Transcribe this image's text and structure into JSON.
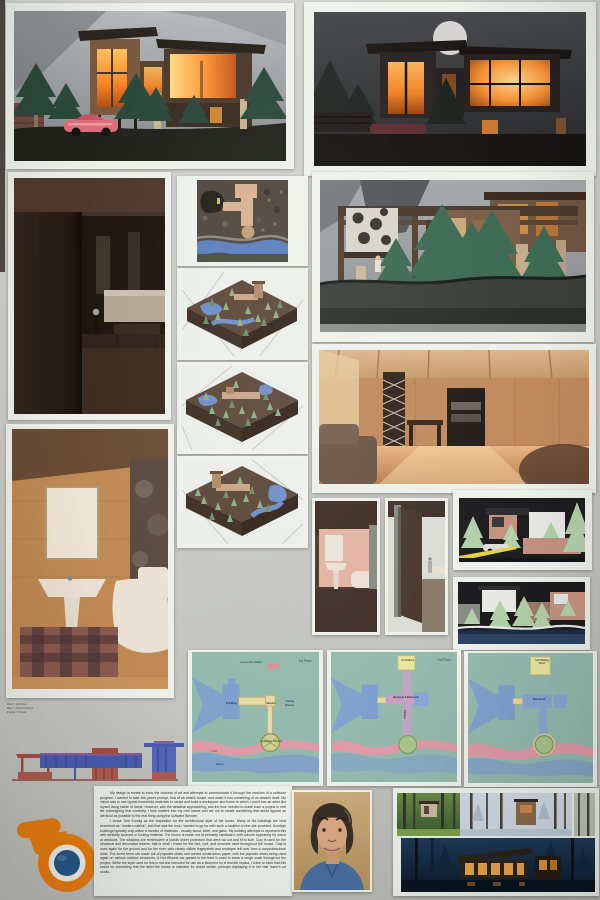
{
  "plans": [
    {
      "title": "1st Floor",
      "callout": "Guest Bed/Bath →",
      "parking": "Parking",
      "studio": "Studio",
      "living": "Living Room",
      "garden": "Sculpture Garden",
      "trail": "Trail",
      "river": "River"
    },
    {
      "title": "2nd Floor",
      "callout": "Art Gallery",
      "rooms": "Bedroom & Bathroom",
      "library": "Library"
    },
    {
      "callout": "Tall Sliding Roof",
      "roof": "Main Roof"
    }
  ],
  "legend": {
    "line1": "Red = 1st Floor",
    "line2": "Blue = Second Floor",
    "line3": "Purple = Roofs"
  },
  "statement": {
    "paragraph1": "My design is meant to echo the concept of art and attempts to communicate it through the medium of a software program. I wanted to take this year's prompt, that of an artist's house, and make it into something of an artwork itself. My vision was to use typical household materials to sculpt and build a workspace and home in which I could see an artist like myself living inside of home. However, with the deadline approaching, and the time needed to make such a project in real life outweighing that creativity, I took matters into my own hands and set out to create something that would appear as identical as possible to the real thing using the software Blender.",
    "paragraph2": "I chose Tom Kundig as the inspiration for the architectural style of the house. Many of his buildings are best described as \"modern cabins\", and that was the look I wanted to go for with such a location on the site provided. Kundig's buildings typically only utilize a handful of materials - usually wood, steel, and glass. My building attempts to represent this with similarly sourced or looking material. The house is made out of primarily cardboard, with cutouts appearing for doors or windows. The windows are reminiscent of plastic sheet protectors that were cut out and fit to size. Clay is used for the structural and decorative beams; that is what I chose for the bed, roof, and concrete used throughout the house. Clay is used again for the ground and for the river, with clearly visible fingerprints and smudges left over from a nonprofessional artist. The forest trees are made out of popsicle sticks and curved construction paper, with the popsicle sticks being used again on various outdoor structures. A Hot Wheels car parked in the front is used to show a rough scale throughout the project. While the style used for this is not one intended for use as a blueprint for a real-life replica, I'd like to think that this would be something that the artist the house is intended for would create, perhaps displaying it in her real home's art studio."
  },
  "colors": {
    "blender_orange": "#e87d0d",
    "blender_blue": "#265787",
    "plan_teal": "#93b9ad",
    "plan_blue": "#7e9ecd",
    "plan_trail_pink": "#de9aa6",
    "plan_tan": "#e7d7a2",
    "elevation_red": "#a84c44",
    "elevation_blue": "#4a5cb0",
    "window_glow": "#ff9a3a"
  }
}
